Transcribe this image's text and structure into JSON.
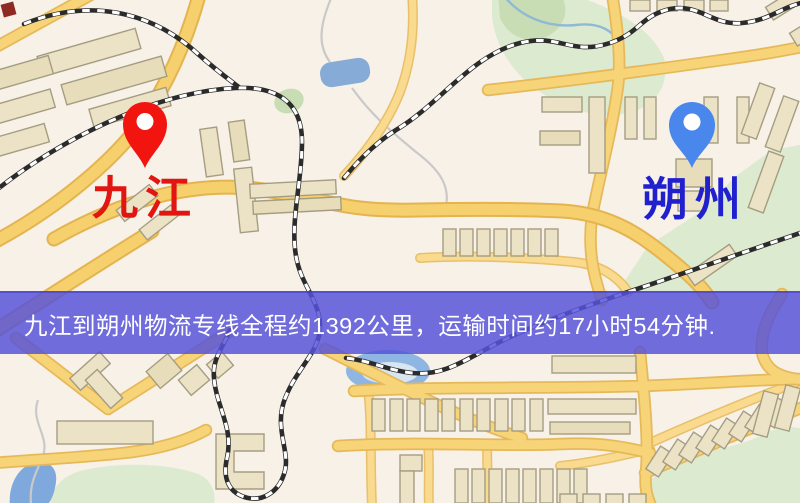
{
  "banner": {
    "text": "九江到朔州物流专线全程约1392公里，运输时间约17小时54分钟.",
    "distance_km": "1392",
    "duration_hours": "17",
    "duration_minutes": "54",
    "bg_color": "#5652d9",
    "text_color": "#ffffff"
  },
  "map": {
    "origin_marker": {
      "label": "九江",
      "pin_color": "#f2140e",
      "label_color": "#e11511"
    },
    "destination_marker": {
      "label": "朔州",
      "pin_color": "#4a87ec",
      "label_color": "#2120cf"
    },
    "palette": {
      "background": "#f7f1e8",
      "road_fill": "#f7d06e",
      "road_casing": "#e3b44f",
      "building_fill": "#ece3c6",
      "building_stroke": "#a59d82",
      "park_green": "#dcead0",
      "water_blue": "#85abd6",
      "railway_dark": "#2b2b2b",
      "railway_light": "#ffffff"
    }
  }
}
